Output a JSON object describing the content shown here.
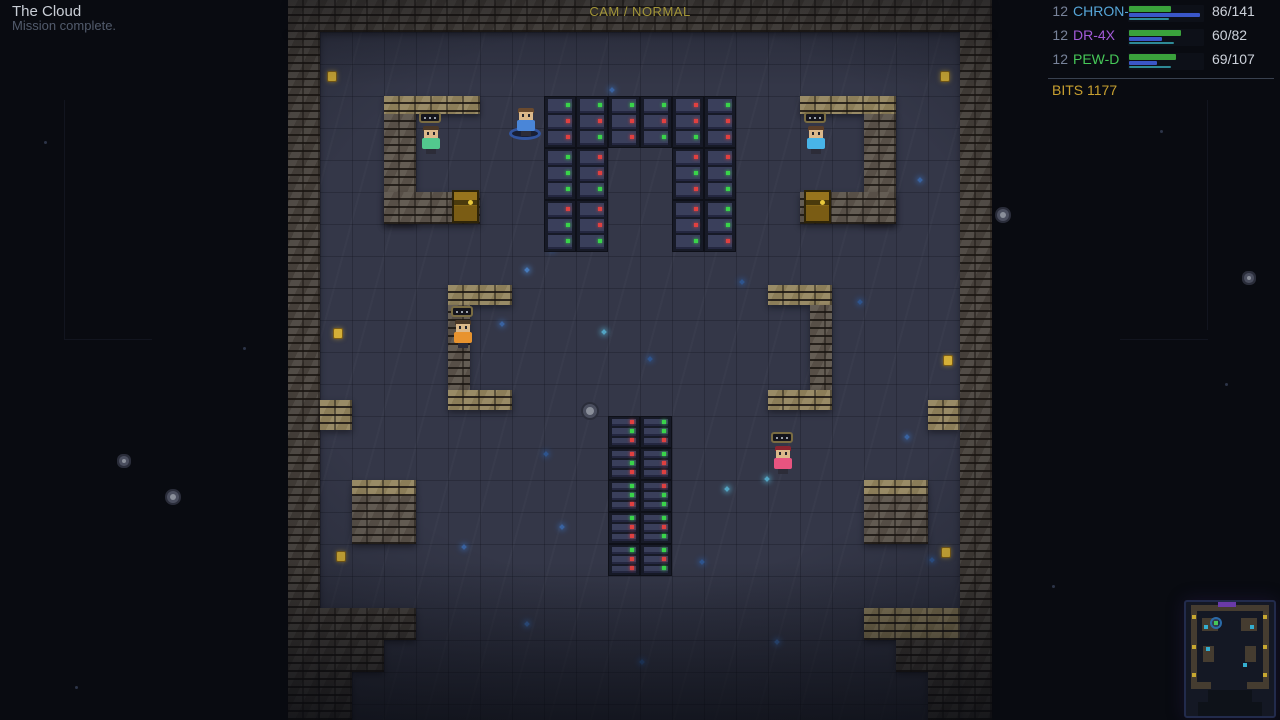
{
  "hud": {
    "title": "The Cloud",
    "subtitle": "Mission complete.",
    "camera_mode": "CAM / NORMAL",
    "bits": "BITS 1177",
    "party": [
      {
        "index": "12",
        "name": "CHRON-B",
        "name_color": "#56a6d8",
        "hp": "86/141",
        "bars": {
          "green": 42,
          "blue": 71,
          "teal": 40
        }
      },
      {
        "index": "12",
        "name": "DR-4X",
        "name_color": "#a35ad8",
        "hp": "60/82",
        "bars": {
          "green": 52,
          "blue": 33,
          "teal": 45
        }
      },
      {
        "index": "12",
        "name": "PEW-D",
        "name_color": "#46c858",
        "hp": "69/107",
        "bars": {
          "green": 47,
          "blue": 28,
          "teal": 42
        }
      }
    ]
  },
  "colors": {
    "bar_green": "#3aa23c",
    "bar_blue": "#3a56c8",
    "bar_teal": "#2e8a96",
    "led_green": "#39d44a",
    "led_red": "#e04040",
    "wall_dark": "#49433d",
    "wall_mid": "#5c544b",
    "wall_tan": "#94855e",
    "floor": "#343748",
    "void": "#090b11",
    "bits_text": "#c8a030"
  },
  "map": {
    "walls": [
      [
        288,
        0,
        704,
        32,
        "dark"
      ],
      [
        288,
        32,
        32,
        688,
        "dark"
      ],
      [
        960,
        32,
        32,
        688,
        "dark"
      ],
      [
        320,
        400,
        32,
        30,
        "tan"
      ],
      [
        928,
        400,
        32,
        30,
        "tan"
      ],
      [
        320,
        608,
        96,
        32,
        "dark"
      ],
      [
        320,
        640,
        64,
        32,
        "dark"
      ],
      [
        320,
        672,
        32,
        48,
        "dark"
      ],
      [
        864,
        608,
        96,
        32,
        "tan"
      ],
      [
        896,
        640,
        64,
        32,
        "dark"
      ],
      [
        928,
        672,
        32,
        48,
        "dark"
      ],
      [
        384,
        96,
        96,
        18,
        "tan"
      ],
      [
        384,
        114,
        32,
        110,
        "mid"
      ],
      [
        384,
        192,
        96,
        32,
        "mid"
      ],
      [
        800,
        96,
        96,
        18,
        "tan"
      ],
      [
        864,
        114,
        32,
        110,
        "mid"
      ],
      [
        800,
        192,
        96,
        32,
        "mid"
      ],
      [
        448,
        285,
        64,
        20,
        "tan"
      ],
      [
        448,
        305,
        22,
        86,
        "mid"
      ],
      [
        448,
        390,
        64,
        20,
        "tan"
      ],
      [
        768,
        285,
        64,
        20,
        "tan"
      ],
      [
        810,
        305,
        22,
        86,
        "mid"
      ],
      [
        768,
        390,
        64,
        20,
        "tan"
      ],
      [
        352,
        480,
        64,
        16,
        "tan"
      ],
      [
        352,
        496,
        64,
        48,
        "mid"
      ],
      [
        864,
        480,
        64,
        16,
        "tan"
      ],
      [
        864,
        496,
        64,
        48,
        "mid"
      ]
    ],
    "server_blocks": [
      {
        "x": 544,
        "y": 96,
        "cols": 6,
        "rows": 1,
        "unit_h": 52
      },
      {
        "x": 544,
        "y": 148,
        "cols": 2,
        "rows": 2,
        "unit_h": 52
      },
      {
        "x": 672,
        "y": 148,
        "cols": 2,
        "rows": 2,
        "unit_h": 52
      },
      {
        "x": 608,
        "y": 416,
        "cols": 2,
        "rows": 5,
        "unit_h": 32
      }
    ],
    "led_pattern": "grrgrggrrgrgrrggrrgg",
    "characters": [
      {
        "name": "crew-green",
        "x": 418,
        "y": 112,
        "shirt": "#52c88e",
        "hair": "#4a3828",
        "bubble": true,
        "ring": false
      },
      {
        "name": "crew-blue",
        "x": 513,
        "y": 94,
        "shirt": "#4a86d8",
        "hair": "#6a4a2e",
        "bubble": false,
        "ring": true
      },
      {
        "name": "crew-skyblue",
        "x": 803,
        "y": 112,
        "shirt": "#48b4e8",
        "hair": "#5a3e2a",
        "bubble": true,
        "ring": false
      },
      {
        "name": "crew-orange",
        "x": 450,
        "y": 306,
        "shirt": "#e8932e",
        "hair": "#4a3828",
        "bubble": true,
        "ring": false
      },
      {
        "name": "crew-pink",
        "x": 770,
        "y": 432,
        "shirt": "#e85480",
        "hair": "#8a2430",
        "bubble": true,
        "ring": false
      }
    ],
    "chests": [
      [
        452,
        190
      ],
      [
        804,
        190
      ]
    ],
    "coins": [
      [
        327,
        71
      ],
      [
        940,
        71
      ],
      [
        333,
        328
      ],
      [
        943,
        355
      ],
      [
        336,
        551
      ],
      [
        941,
        547
      ]
    ],
    "speckles": [
      [
        525,
        268,
        "#4a86d0"
      ],
      [
        550,
        247,
        "#2e5a9a"
      ],
      [
        602,
        330,
        "#58b7d9"
      ],
      [
        648,
        357,
        "#2e5a9a"
      ],
      [
        500,
        322,
        "#3a6ab0"
      ],
      [
        725,
        487,
        "#58b7d9"
      ],
      [
        544,
        452,
        "#2e5a9a"
      ],
      [
        462,
        545,
        "#3a6ab0"
      ],
      [
        700,
        560,
        "#2e5a9a"
      ],
      [
        905,
        435,
        "#3a6ab0"
      ],
      [
        930,
        558,
        "#2e5a9a"
      ],
      [
        525,
        622,
        "#3a6ab0"
      ],
      [
        640,
        660,
        "#2e5a9a"
      ],
      [
        775,
        640,
        "#3a6ab0"
      ],
      [
        858,
        300,
        "#2e5a9a"
      ],
      [
        918,
        178,
        "#3a6ab0"
      ],
      [
        740,
        280,
        "#2e5a9a"
      ],
      [
        560,
        525,
        "#3a6ab0"
      ],
      [
        765,
        477,
        "#58b7d9"
      ],
      [
        610,
        88,
        "#3a6ab0"
      ]
    ],
    "stones": [
      [
        586,
        407,
        16
      ],
      [
        170,
        494,
        12
      ],
      [
        1000,
        212,
        12
      ],
      [
        122,
        459,
        8
      ],
      [
        1247,
        276,
        8
      ]
    ],
    "void_stars": [
      [
        75,
        686
      ],
      [
        44,
        141
      ],
      [
        243,
        347
      ],
      [
        1225,
        383
      ],
      [
        1052,
        585
      ],
      [
        1160,
        130
      ]
    ],
    "void_lines": [
      [
        64,
        100,
        1,
        240
      ],
      [
        64,
        339,
        88,
        1
      ],
      [
        1207,
        100,
        1,
        230
      ],
      [
        1120,
        339,
        88,
        1
      ]
    ]
  },
  "minimap": {
    "x": 1184,
    "y": 600,
    "w": 88,
    "h": 114,
    "wall_rects": [
      [
        5,
        3,
        78,
        6
      ],
      [
        5,
        3,
        6,
        82
      ],
      [
        77,
        3,
        6,
        82
      ],
      [
        16,
        16,
        16,
        13
      ],
      [
        55,
        16,
        16,
        13
      ],
      [
        17,
        44,
        11,
        16
      ],
      [
        59,
        44,
        11,
        16
      ],
      [
        5,
        80,
        20,
        7
      ],
      [
        61,
        80,
        22,
        7
      ]
    ],
    "void_rects": [
      [
        22,
        88,
        44,
        26
      ],
      [
        12,
        100,
        64,
        14
      ]
    ],
    "dots": [
      [
        6,
        13,
        "#c8a830"
      ],
      [
        77,
        13,
        "#c8a830"
      ],
      [
        6,
        43,
        "#c8a830"
      ],
      [
        77,
        43,
        "#c8a830"
      ],
      [
        6,
        71,
        "#c8a830"
      ],
      [
        77,
        71,
        "#c8a830"
      ],
      [
        18,
        23,
        "#34aed0"
      ],
      [
        64,
        23,
        "#34aed0"
      ],
      [
        20,
        45,
        "#34aed0"
      ],
      [
        57,
        61,
        "#34aed0"
      ]
    ],
    "player": [
      24,
      15
    ],
    "purple_rect": [
      32,
      0,
      18,
      5
    ]
  }
}
